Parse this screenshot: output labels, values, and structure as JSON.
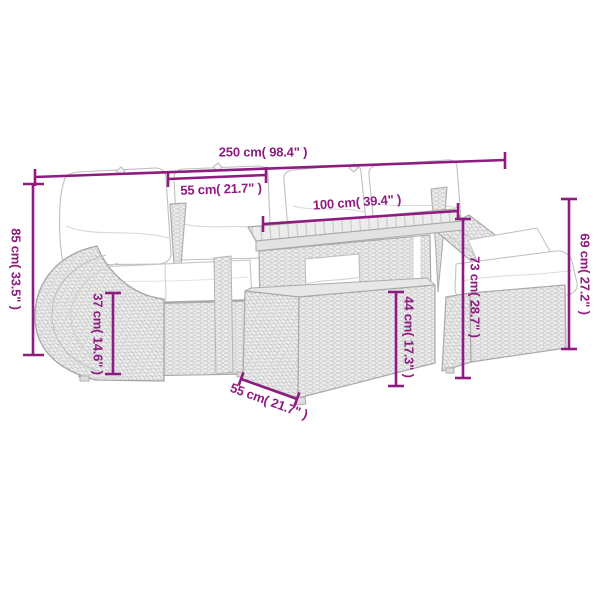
{
  "diagram": {
    "type": "product-dimension-diagram",
    "product": "poly-rattan garden lounge set with table, cushions and stool",
    "accent_color": "#8e1b80",
    "line_art_color": "#a9a9a9",
    "background_color": "#ffffff",
    "dimensions": [
      {
        "id": "overall-width",
        "label": "250 cm( 98.4\" )",
        "value_cm": 250,
        "value_in": 98.4,
        "orientation": "horizontal"
      },
      {
        "id": "seat-width",
        "label": "55 cm( 21.7\" )",
        "value_cm": 55,
        "value_in": 21.7,
        "orientation": "horizontal"
      },
      {
        "id": "table-length",
        "label": "100 cm( 39.4\" )",
        "value_cm": 100,
        "value_in": 39.4,
        "orientation": "horizontal"
      },
      {
        "id": "overall-height",
        "label": "85 cm( 33.5\" )",
        "value_cm": 85,
        "value_in": 33.5,
        "orientation": "vertical"
      },
      {
        "id": "seat-height",
        "label": "37 cm( 14.6\" )",
        "value_cm": 37,
        "value_in": 14.6,
        "orientation": "vertical"
      },
      {
        "id": "back-height",
        "label": "73 cm( 28.7\" )",
        "value_cm": 73,
        "value_in": 28.7,
        "orientation": "vertical"
      },
      {
        "id": "table-height",
        "label": "44 cm( 17.3\" )",
        "value_cm": 44,
        "value_in": 17.3,
        "orientation": "vertical"
      },
      {
        "id": "stool-height",
        "label": "69 cm( 27.2\" )",
        "value_cm": 69,
        "value_in": 27.2,
        "orientation": "vertical"
      },
      {
        "id": "seat-depth",
        "label": "55 cm( 21.7\" )",
        "value_cm": 55,
        "value_in": 21.7,
        "orientation": "diagonal"
      }
    ]
  }
}
